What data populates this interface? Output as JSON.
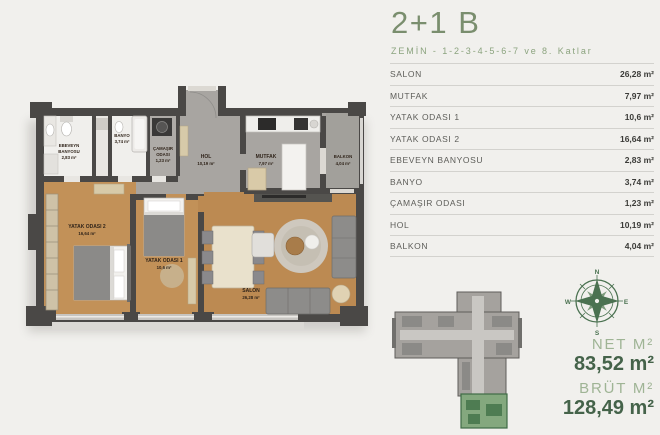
{
  "header": {
    "title": "2+1 B",
    "subtitle": "ZEMİN - 1-2-3-4-5-6-7 ve 8. Katlar"
  },
  "table": {
    "rows": [
      {
        "label": "SALON",
        "value": "26,28 m²"
      },
      {
        "label": "MUTFAK",
        "value": "7,97 m²"
      },
      {
        "label": "YATAK ODASI 1",
        "value": "10,6 m²"
      },
      {
        "label": "YATAK ODASI 2",
        "value": "16,64 m²"
      },
      {
        "label": "EBEVEYN BANYOSU",
        "value": "2,83 m²"
      },
      {
        "label": "BANYO",
        "value": "3,74 m²"
      },
      {
        "label": "ÇAMAŞIR ODASI",
        "value": "1,23 m²"
      },
      {
        "label": "HOL",
        "value": "10,19 m²"
      },
      {
        "label": "BALKON",
        "value": "4,04 m²"
      }
    ]
  },
  "summary": {
    "net_label": "NET M²",
    "net_value": "83,52 m²",
    "brut_label": "BRÜT M²",
    "brut_value": "128,49 m²"
  },
  "compass": {
    "n": "N",
    "e": "E",
    "s": "S",
    "w": "W"
  },
  "floorplan": {
    "labels": [
      {
        "lines": [
          "EBEVEYN",
          "BANYOSU"
        ],
        "area": "2,83 m²"
      },
      {
        "lines": [
          "BANYO"
        ],
        "area": "3,74 m²"
      },
      {
        "lines": [
          "ÇAMAŞIR",
          "ODASI"
        ],
        "area": "1,23 m²"
      },
      {
        "lines": [
          "HOL"
        ],
        "area": "10,19 m²"
      },
      {
        "lines": [
          "MUTFAK"
        ],
        "area": "7,97 m²"
      },
      {
        "lines": [
          "BALKON"
        ],
        "area": "4,04 m²"
      },
      {
        "lines": [
          "YATAK ODASI 2"
        ],
        "area": "16,64 m²"
      },
      {
        "lines": [
          "YATAK ODASI 1"
        ],
        "area": "10,6 m²"
      },
      {
        "lines": [
          "SALON"
        ],
        "area": "26,28 m²"
      }
    ]
  },
  "colors": {
    "accent_green": "#7a8e6e",
    "light_green": "#9fb495",
    "dark_green": "#45634a",
    "compass_green": "#4b7251",
    "wall": "#4a4846",
    "wood_floor": "#c29158",
    "unit_highlight_green": "#84a87e"
  }
}
